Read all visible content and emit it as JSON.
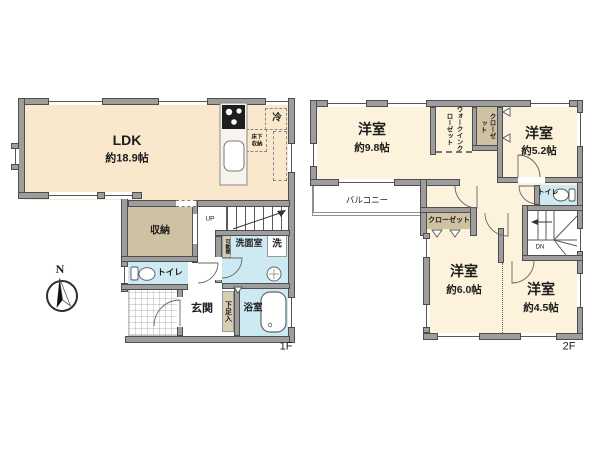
{
  "compass": {
    "north_label": "N"
  },
  "floor1": {
    "floor_label": "1F",
    "ldk_label": "LDK",
    "ldk_size": "約18.9帖",
    "storage_label": "収納",
    "toilet_label": "トイレ",
    "entrance_label": "玄関",
    "shoe_cabinet_label": "下足入",
    "bathroom_label": "浴室",
    "washroom_label": "洗面室",
    "washing_machine_label": "洗",
    "underfloor_storage_label": "床下収納",
    "refrigerator_label": "冷",
    "movable_shelf_label": "可動棚",
    "stairs_up_label": "UP"
  },
  "floor2": {
    "floor_label": "2F",
    "bedroom_nw_label": "洋室",
    "bedroom_nw_size": "約9.8帖",
    "bedroom_ne_label": "洋室",
    "bedroom_ne_size": "約5.2帖",
    "bedroom_sw_label": "洋室",
    "bedroom_sw_size": "約6.0帖",
    "bedroom_se_label": "洋室",
    "bedroom_se_size": "約4.5帖",
    "walk_in_closet_label": "ウォークインクローゼット",
    "closet_north_label": "クローゼット",
    "closet_south_label": "クローゼット",
    "balcony_label": "バルコニー",
    "toilet_label": "トイレ",
    "stairs_down_label": "DN"
  },
  "colors": {
    "wall": "#9d9d9d",
    "wall_outline": "#4e4e4e",
    "ldk_floor": "#fae8cc",
    "bedroom_floor": "#fdf3dc",
    "storage_floor": "#cfc2a3",
    "wet_area_floor": "#cde9f2"
  }
}
